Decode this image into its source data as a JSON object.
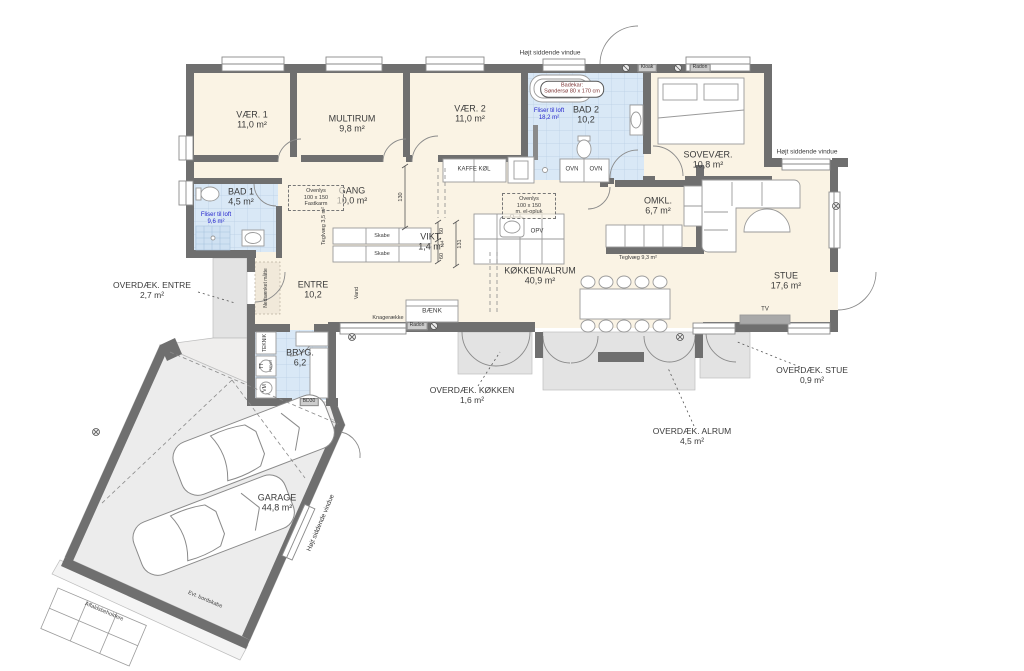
{
  "colors": {
    "wall": "#6f6f6f",
    "room_fill": "#faf3e4",
    "wet_fill": "#d9e8f6",
    "porch_fill": "#e3e3e3",
    "garage_fill": "#ececec",
    "note_blue": "#2222cc"
  },
  "rooms": [
    {
      "name": "VÆR. 1",
      "area": "11,0 m²"
    },
    {
      "name": "MULTIRUM",
      "area": "9,8 m²"
    },
    {
      "name": "VÆR. 2",
      "area": "11,0 m²"
    },
    {
      "name": "BAD 1",
      "area": "4,5 m²"
    },
    {
      "name": "GANG",
      "area": "10,0 m²"
    },
    {
      "name": "VIKT.",
      "area": "1,4 m²"
    },
    {
      "name": "BAD 2",
      "area": "10,2"
    },
    {
      "name": "SOVEVÆR.",
      "area": "10,8 m²"
    },
    {
      "name": "OMKL.",
      "area": "6,7 m²"
    },
    {
      "name": "KØKKEN/ALRUM",
      "area": "40,9 m²"
    },
    {
      "name": "STUE",
      "area": "17,6 m²"
    },
    {
      "name": "ENTRE",
      "area": "10,2"
    },
    {
      "name": "BRYG.",
      "area": "6,2"
    },
    {
      "name": "GARAGE",
      "area": "44,8 m²"
    }
  ],
  "outdoor": [
    {
      "name": "OVERDÆK. ENTRE",
      "area": "2,7 m²"
    },
    {
      "name": "OVERDÆK. KØKKEN",
      "area": "1,6 m²"
    },
    {
      "name": "OVERDÆK. ALRUM",
      "area": "4,5 m²"
    },
    {
      "name": "OVERDÆK. STUE",
      "area": "0,9 m²"
    }
  ],
  "notes": {
    "high_window": "Højt siddende vindue",
    "badekar_l1": "Badekar:",
    "badekar_l2": "Søndersø 80 x 170 cm",
    "fliser": "Fliser til loft",
    "fliser_bad2_area": "18,2 m²",
    "fliser_bad1_area": "9,6 m²",
    "ovenlys": "Ovenlys",
    "ovenlys_size": "100 x 150",
    "ovenlys1_type": "Fastkarm",
    "ovenlys2_type": "m. el-opluk",
    "teglvaeg_gang": "Teglvæg 3,5 m²",
    "teglvaeg_omkl": "Teglvæg 9,3 m²",
    "nedsaenket": "Nedsænket måtte",
    "affald": "Affaldsbeholdere",
    "bordskabe": "Evt. bordskabe"
  },
  "fixtures": {
    "kaffe_koel": "KAFFE KØL",
    "ovn": "OVN",
    "ovn2": "OVN",
    "opv": "OPV",
    "skabe": "Skabe",
    "skabe2": "Skabe",
    "baenk": "BÆNK",
    "knageraekke": "Knagerække",
    "teknik": "TEKNIK",
    "tt": "TT",
    "haevet": "Hævet",
    "vm": "VM",
    "vand": "Vand",
    "tv": "TV",
    "bd30": "BD30",
    "kloak": "Kloak",
    "radon": "Radon",
    "radon_wall": "Radon"
  },
  "dimensions": {
    "gang_width": "130",
    "vikt_w1": "60",
    "vikt_gap": "14",
    "vikt_w2": "60",
    "vikt_total": "131"
  }
}
